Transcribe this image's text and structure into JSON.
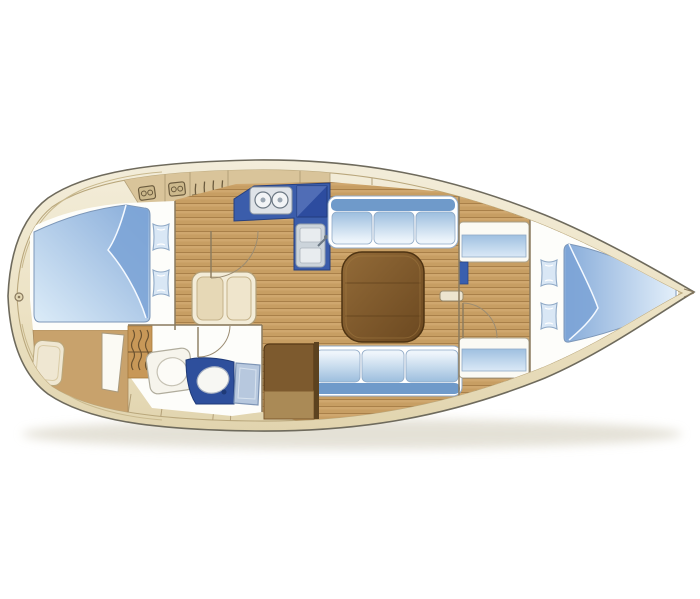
{
  "diagram": {
    "type": "sailboat-interior-floor-plan",
    "view": "top-down",
    "orientation": {
      "bow": "right",
      "stern": "left"
    },
    "background": "#ffffff"
  },
  "rooms": [
    {
      "id": "aft-cabin",
      "name": "aft double cabin",
      "fixtures": [
        "double-berth",
        "pillow",
        "pillow",
        "cabinet",
        "door"
      ]
    },
    {
      "id": "head",
      "name": "head / bathroom",
      "fixtures": [
        "toilet",
        "vanity-sink",
        "hanging-locker",
        "door-leaf",
        "door-arc"
      ]
    },
    {
      "id": "companionway",
      "name": "companionway steps",
      "fixtures": [
        "steps"
      ]
    },
    {
      "id": "galley",
      "name": "galley",
      "fixtures": [
        "two-burner-stove",
        "icebox",
        "double-sink"
      ]
    },
    {
      "id": "salon",
      "name": "salon",
      "fixtures": [
        "table",
        "port-settee",
        "starboard-settee",
        "mast-post"
      ]
    },
    {
      "id": "nav-station",
      "name": "navigation station",
      "fixtures": [
        "chart-table"
      ]
    },
    {
      "id": "forward-passage",
      "name": "forward passage",
      "fixtures": [
        "locker",
        "locker",
        "door-arc"
      ]
    },
    {
      "id": "forward-cabin",
      "name": "forward V-berth cabin",
      "fixtures": [
        "v-berth",
        "pillow",
        "pillow"
      ]
    },
    {
      "id": "bow-locker",
      "name": "anchor locker",
      "fixtures": []
    }
  ],
  "counts": {
    "pillows": 4,
    "stove_burners": 2,
    "settee_cushions": 6,
    "deck_hatches": 16,
    "grab_rails": 3
  },
  "colors": {
    "background": "#ffffff",
    "hull_fill": "#ede4c8",
    "hull_fill_light": "#f3edda",
    "hull_outline": "#6e6a5c",
    "deck_tan": "#d9c49a",
    "deck_seam": "#b3a078",
    "icon_stroke": "#6b5b3e",
    "wood_light": "#cfa76e",
    "wood_line": "#a98049",
    "corridor_tan": "#c8a26c",
    "room_white": "#fdfdfa",
    "counter_blue": "#3b5dab",
    "icebox_blue": "#2d4c9f",
    "icebox_lid": "#6e89c8",
    "vanity_blue": "#2e4f9c",
    "cushion_dark": "#6f9aca",
    "cushion_light": "#dcebf8",
    "cushion_stroke": "#8fa9c6",
    "bed_blue": "#86abd9",
    "bed_fold": "#7ba3d6",
    "pillow_fill": "#d9e7f5",
    "table_brown": "#8f6736",
    "table_brown_dark": "#6b4820",
    "table_stroke": "#4e3312",
    "chart_table": "#7d5a2e",
    "chart_table_light": "#aa8a56",
    "chart_table_edge": "#5c421f",
    "steps_cream": "#f3ecd8",
    "steps_tread": "#e6d8b6",
    "door_leaf": "#b7c8de",
    "door_leaf_stroke": "#7e95b5",
    "fixture_white": "#f6f4ec",
    "appliance_gray": "#dfe3e8",
    "appliance_stroke": "#8b96a2",
    "wall": "#8a7a5e",
    "arc": "#9b8c72",
    "shadow": "#dedacd"
  }
}
